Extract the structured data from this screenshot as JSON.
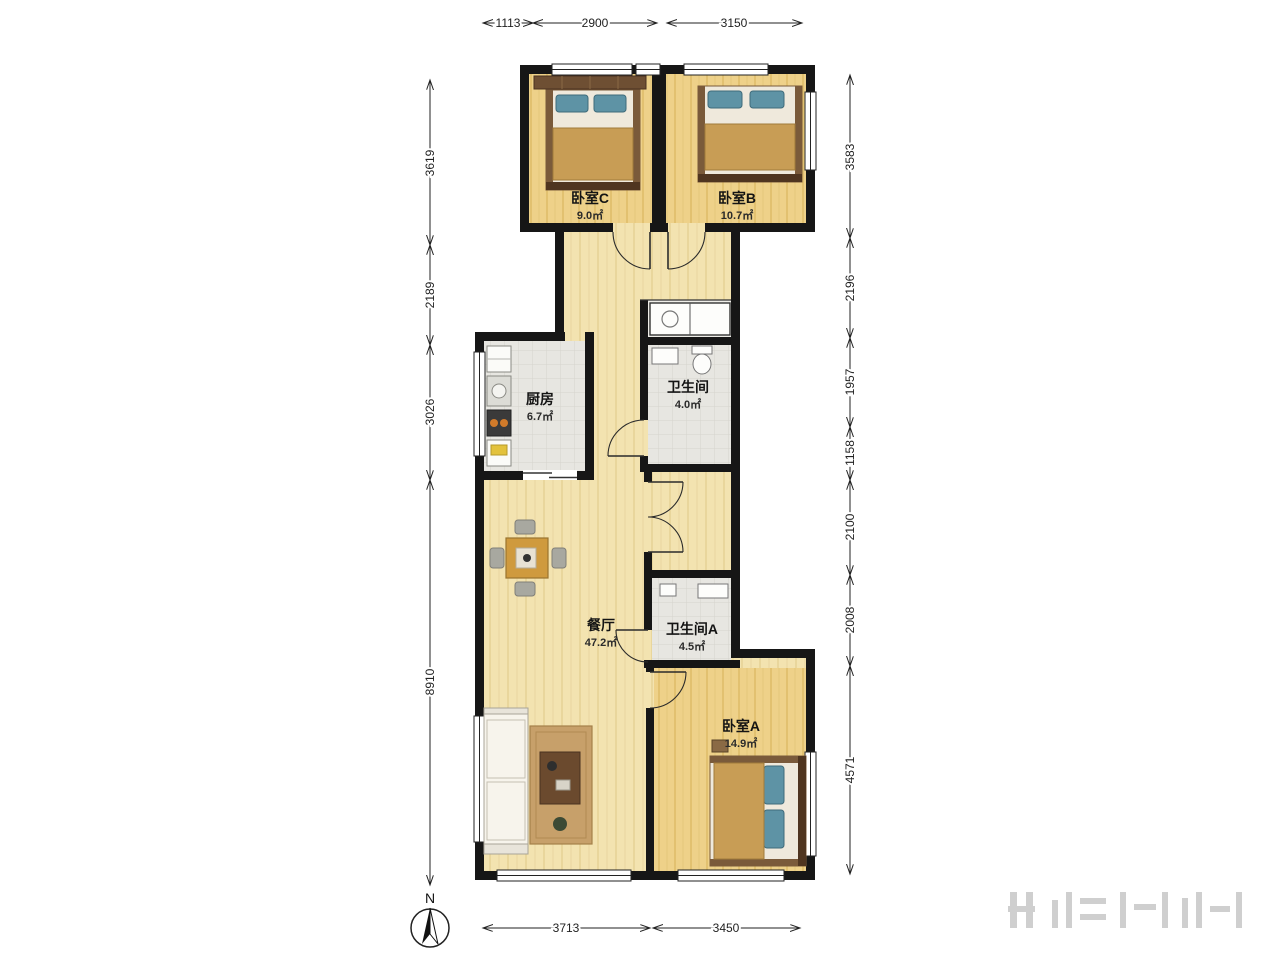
{
  "plan": {
    "rooms": {
      "bedroom_c": {
        "name": "卧室C",
        "area": "9.0㎡"
      },
      "bedroom_b": {
        "name": "卧室B",
        "area": "10.7㎡"
      },
      "kitchen": {
        "name": "厨房",
        "area": "6.7㎡"
      },
      "bathroom": {
        "name": "卫生间",
        "area": "4.0㎡"
      },
      "dining_living": {
        "name": "餐厅",
        "area": "47.2㎡"
      },
      "bathroom_a": {
        "name": "卫生间A",
        "area": "4.5㎡"
      },
      "bedroom_a": {
        "name": "卧室A",
        "area": "14.9㎡"
      }
    },
    "dimensions_mm": {
      "top": [
        "1113",
        "2900",
        "3150"
      ],
      "bottom": [
        "3713",
        "3450"
      ],
      "left": [
        "3619",
        "2189",
        "3026",
        "8910"
      ],
      "right": [
        "3583",
        "2196",
        "1957",
        "1158",
        "2100",
        "2008",
        "4571"
      ]
    },
    "compass": {
      "north_label": "N"
    },
    "colors": {
      "wall": "#161616",
      "floor_living": "#f3e3b0",
      "floor_bedroom": "#eed189",
      "floor_tile": "#e7e6e1",
      "blanket_wood": "#c89d55",
      "pillow_teal": "#5e93a5"
    }
  }
}
